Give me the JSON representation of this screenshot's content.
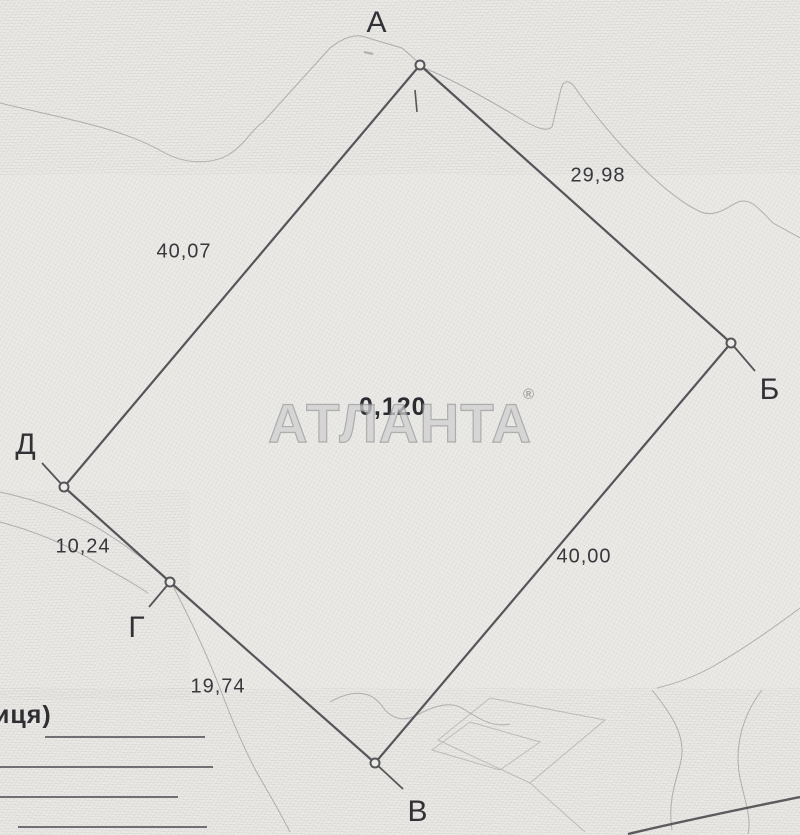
{
  "map": {
    "title_watermark": {
      "text": "АТЛАНТА",
      "registered": "®"
    },
    "area_label": "0,120",
    "street_label_fragment": "иця)",
    "vertices": [
      {
        "id": "A",
        "label": "А"
      },
      {
        "id": "B",
        "label": "Б"
      },
      {
        "id": "V",
        "label": "В"
      },
      {
        "id": "G",
        "label": "Г"
      },
      {
        "id": "D",
        "label": "Д"
      }
    ],
    "sides": [
      {
        "from": "А",
        "to": "Б",
        "length": "29,98"
      },
      {
        "from": "Б",
        "to": "В",
        "length": "40,00"
      },
      {
        "from": "В",
        "to": "Г",
        "length": "19,74"
      },
      {
        "from": "Г",
        "to": "Д",
        "length": "10,24"
      },
      {
        "from": "Д",
        "to": "А",
        "length": "40,07"
      }
    ],
    "colors": {
      "paper": "#ebeae6",
      "boundary_line": "#55555a",
      "label_text": "#323236",
      "watermark": "#b9b9ba"
    }
  }
}
